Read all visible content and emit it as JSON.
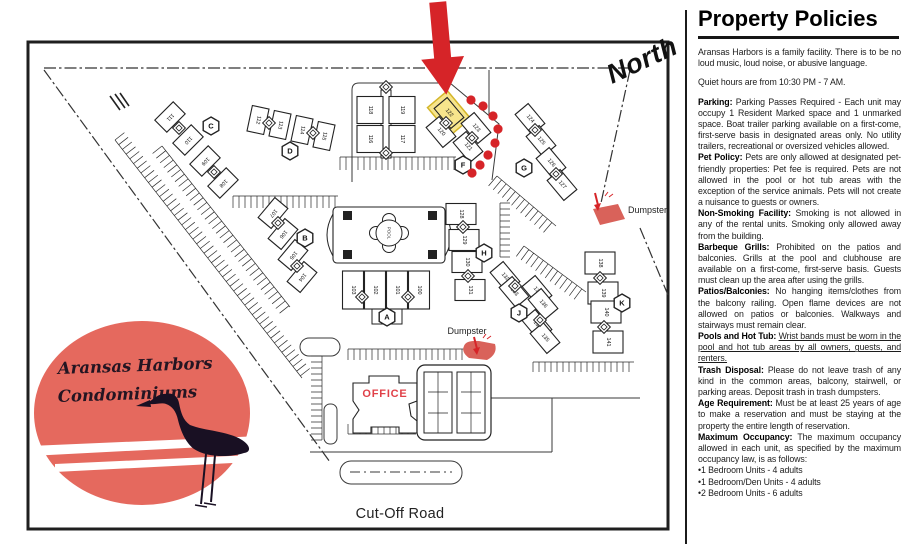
{
  "panel": {
    "title": "Property Policies",
    "intro": "Aransas Harbors is a family facility. There is to be no loud music, loud noise, or abusive language.",
    "quiet_hours": "Quiet hours are from 10:30 PM - 7 AM.",
    "sections": [
      {
        "label": "Parking:",
        "text": "Parking Passes Required - Each unit may occupy 1 Resident Marked space and 1 unmarked space. Boat trailer parking available on a first-come, first-serve basis in designated areas only. No utility trailers, recreational or oversized vehicles allowed."
      },
      {
        "label": "Pet Policy:",
        "text": "Pets are only allowed at designated pet-friendly properties: Pet fee is required. Pets are not allowed in the pool or hot tub areas with the exception of the service animals. Pets will not create a nuisance to guests or owners."
      },
      {
        "label": "Non-Smoking Facility:",
        "text": "Smoking is not allowed in any of the rental units. Smoking only allowed away from the building."
      },
      {
        "label": "Barbeque Grills:",
        "text": "Prohibited on the patios and balconies. Grills at the pool and clubhouse are available on a first-come, first-serve basis. Guests must clean up the area after using the grills."
      },
      {
        "label": "Patios/Balconies:",
        "text": "No hanging items/clothes from the balcony railing. Open flame devices are not allowed on patios or balconies. Walkways and stairways must remain clear."
      },
      {
        "label": "Pools and Hot Tub:",
        "text": "Wrist bands must be worn in the pool and hot tub areas by all owners, guests, and renters.",
        "underline": true
      },
      {
        "label": "Trash Disposal:",
        "text": "Please do not leave trash of any kind in the common areas, balcony, stairwell, or parking areas. Deposit trash in trash dumpsters."
      },
      {
        "label": "Age Requirement:",
        "text": "Must be at least 25 years of age to make a reservation and must be staying at the property the entire length of reservation."
      },
      {
        "label": "Maximum Occupancy:",
        "text": "The maximum occupancy allowed in each unit, as specified by the maximum occupancy law, is as follows:"
      }
    ],
    "bullets": [
      "•1 Bedroom Units - 4 adults",
      "•1 Bedroom/Den Units - 4 adults",
      "•2 Bedroom Units - 6 adults"
    ]
  },
  "map": {
    "north_label": "North",
    "road_label": "Cut-Off Road",
    "office_label": "OFFICE",
    "pool_label": "POOL",
    "highlighted_unit": "122",
    "dumpsters": [
      {
        "label": "Dumpster",
        "x": 628,
        "y": 213,
        "anchor": "start"
      },
      {
        "label": "Dumpster",
        "x": 467,
        "y": 334,
        "anchor": "middle"
      }
    ],
    "logo": {
      "line1": "Aransas Harbors",
      "line2": "Condominiums"
    },
    "colors": {
      "red": "#d62428",
      "coral": "#d9625a",
      "sun": "#e5695e",
      "yellow": "#f6e382",
      "yellow_edge": "#d4b62a",
      "office_red": "#e04048",
      "ink": "#222222"
    },
    "buildings": [
      {
        "n": "111",
        "x": 170,
        "y": 117,
        "r": 45
      },
      {
        "n": "110",
        "x": 188,
        "y": 140,
        "r": 45
      },
      {
        "n": "109",
        "x": 205,
        "y": 161,
        "r": 45
      },
      {
        "n": "108",
        "x": 223,
        "y": 183,
        "r": 45
      },
      {
        "n": "112",
        "x": 258,
        "y": 120,
        "r": 12
      },
      {
        "n": "113",
        "x": 280,
        "y": 125,
        "r": 12
      },
      {
        "n": "114",
        "x": 302,
        "y": 130,
        "r": 12
      },
      {
        "n": "115",
        "x": 324,
        "y": 136,
        "r": 12
      },
      {
        "n": "118",
        "x": 370,
        "y": 110,
        "r": 0,
        "w": 26,
        "h": 27
      },
      {
        "n": "119",
        "x": 402,
        "y": 110,
        "r": 0,
        "w": 26,
        "h": 27
      },
      {
        "n": "116",
        "x": 370,
        "y": 139,
        "r": 0,
        "w": 26,
        "h": 27
      },
      {
        "n": "117",
        "x": 402,
        "y": 139,
        "r": 0,
        "w": 26,
        "h": 27
      },
      {
        "n": "122",
        "x": 449,
        "y": 113,
        "r": -40,
        "hl": true
      },
      {
        "n": "120",
        "x": 441,
        "y": 132,
        "r": -40
      },
      {
        "n": "123",
        "x": 476,
        "y": 128,
        "r": -40
      },
      {
        "n": "121",
        "x": 468,
        "y": 147,
        "r": -40
      },
      {
        "n": "124",
        "x": 530,
        "y": 119,
        "r": -40
      },
      {
        "n": "125",
        "x": 541,
        "y": 141,
        "r": -40
      },
      {
        "n": "126",
        "x": 551,
        "y": 163,
        "r": -40
      },
      {
        "n": "127",
        "x": 562,
        "y": 185,
        "r": -40
      },
      {
        "n": "107",
        "x": 273,
        "y": 213,
        "r": 40
      },
      {
        "n": "106",
        "x": 283,
        "y": 234,
        "r": 40
      },
      {
        "n": "105",
        "x": 293,
        "y": 255,
        "r": 40
      },
      {
        "n": "104",
        "x": 302,
        "y": 277,
        "r": 40
      },
      {
        "n": "103",
        "x": 353,
        "y": 290,
        "r": 0,
        "w": 21,
        "h": 38
      },
      {
        "n": "102",
        "x": 375,
        "y": 290,
        "r": 0,
        "w": 21,
        "h": 38
      },
      {
        "n": "101",
        "x": 397,
        "y": 290,
        "r": 0,
        "w": 21,
        "h": 38
      },
      {
        "n": "100",
        "x": 419,
        "y": 290,
        "r": 0,
        "w": 21,
        "h": 38
      },
      {
        "n": "128",
        "x": 461,
        "y": 214,
        "r": 0,
        "w": 30,
        "h": 21
      },
      {
        "n": "129",
        "x": 464,
        "y": 240,
        "r": 0,
        "w": 30,
        "h": 21
      },
      {
        "n": "130",
        "x": 467,
        "y": 262,
        "r": 0,
        "w": 30,
        "h": 21
      },
      {
        "n": "131",
        "x": 470,
        "y": 290,
        "r": 0,
        "w": 30,
        "h": 21
      },
      {
        "n": "132",
        "x": 505,
        "y": 277,
        "r": -40
      },
      {
        "n": "133",
        "x": 514,
        "y": 292,
        "r": -40
      },
      {
        "n": "137",
        "x": 537,
        "y": 291,
        "r": -40
      },
      {
        "n": "136",
        "x": 543,
        "y": 304,
        "r": -40
      },
      {
        "n": "134",
        "x": 537,
        "y": 325,
        "r": -40
      },
      {
        "n": "135",
        "x": 545,
        "y": 338,
        "r": -40
      },
      {
        "n": "138",
        "x": 600,
        "y": 263,
        "r": 0,
        "w": 30,
        "h": 22
      },
      {
        "n": "139",
        "x": 603,
        "y": 293,
        "r": 0,
        "w": 30,
        "h": 22
      },
      {
        "n": "140",
        "x": 606,
        "y": 312,
        "r": 0,
        "w": 30,
        "h": 22
      },
      {
        "n": "141",
        "x": 608,
        "y": 342,
        "r": 0,
        "w": 30,
        "h": 22
      }
    ],
    "letters": [
      {
        "ch": "A",
        "x": 387,
        "y": 317
      },
      {
        "ch": "B",
        "x": 305,
        "y": 238
      },
      {
        "ch": "C",
        "x": 211,
        "y": 126
      },
      {
        "ch": "D",
        "x": 290,
        "y": 151
      },
      {
        "ch": "F",
        "x": 463,
        "y": 165
      },
      {
        "ch": "G",
        "x": 524,
        "y": 168
      },
      {
        "ch": "H",
        "x": 484,
        "y": 253
      },
      {
        "ch": "J",
        "x": 519,
        "y": 313
      },
      {
        "ch": "K",
        "x": 622,
        "y": 303
      }
    ]
  }
}
